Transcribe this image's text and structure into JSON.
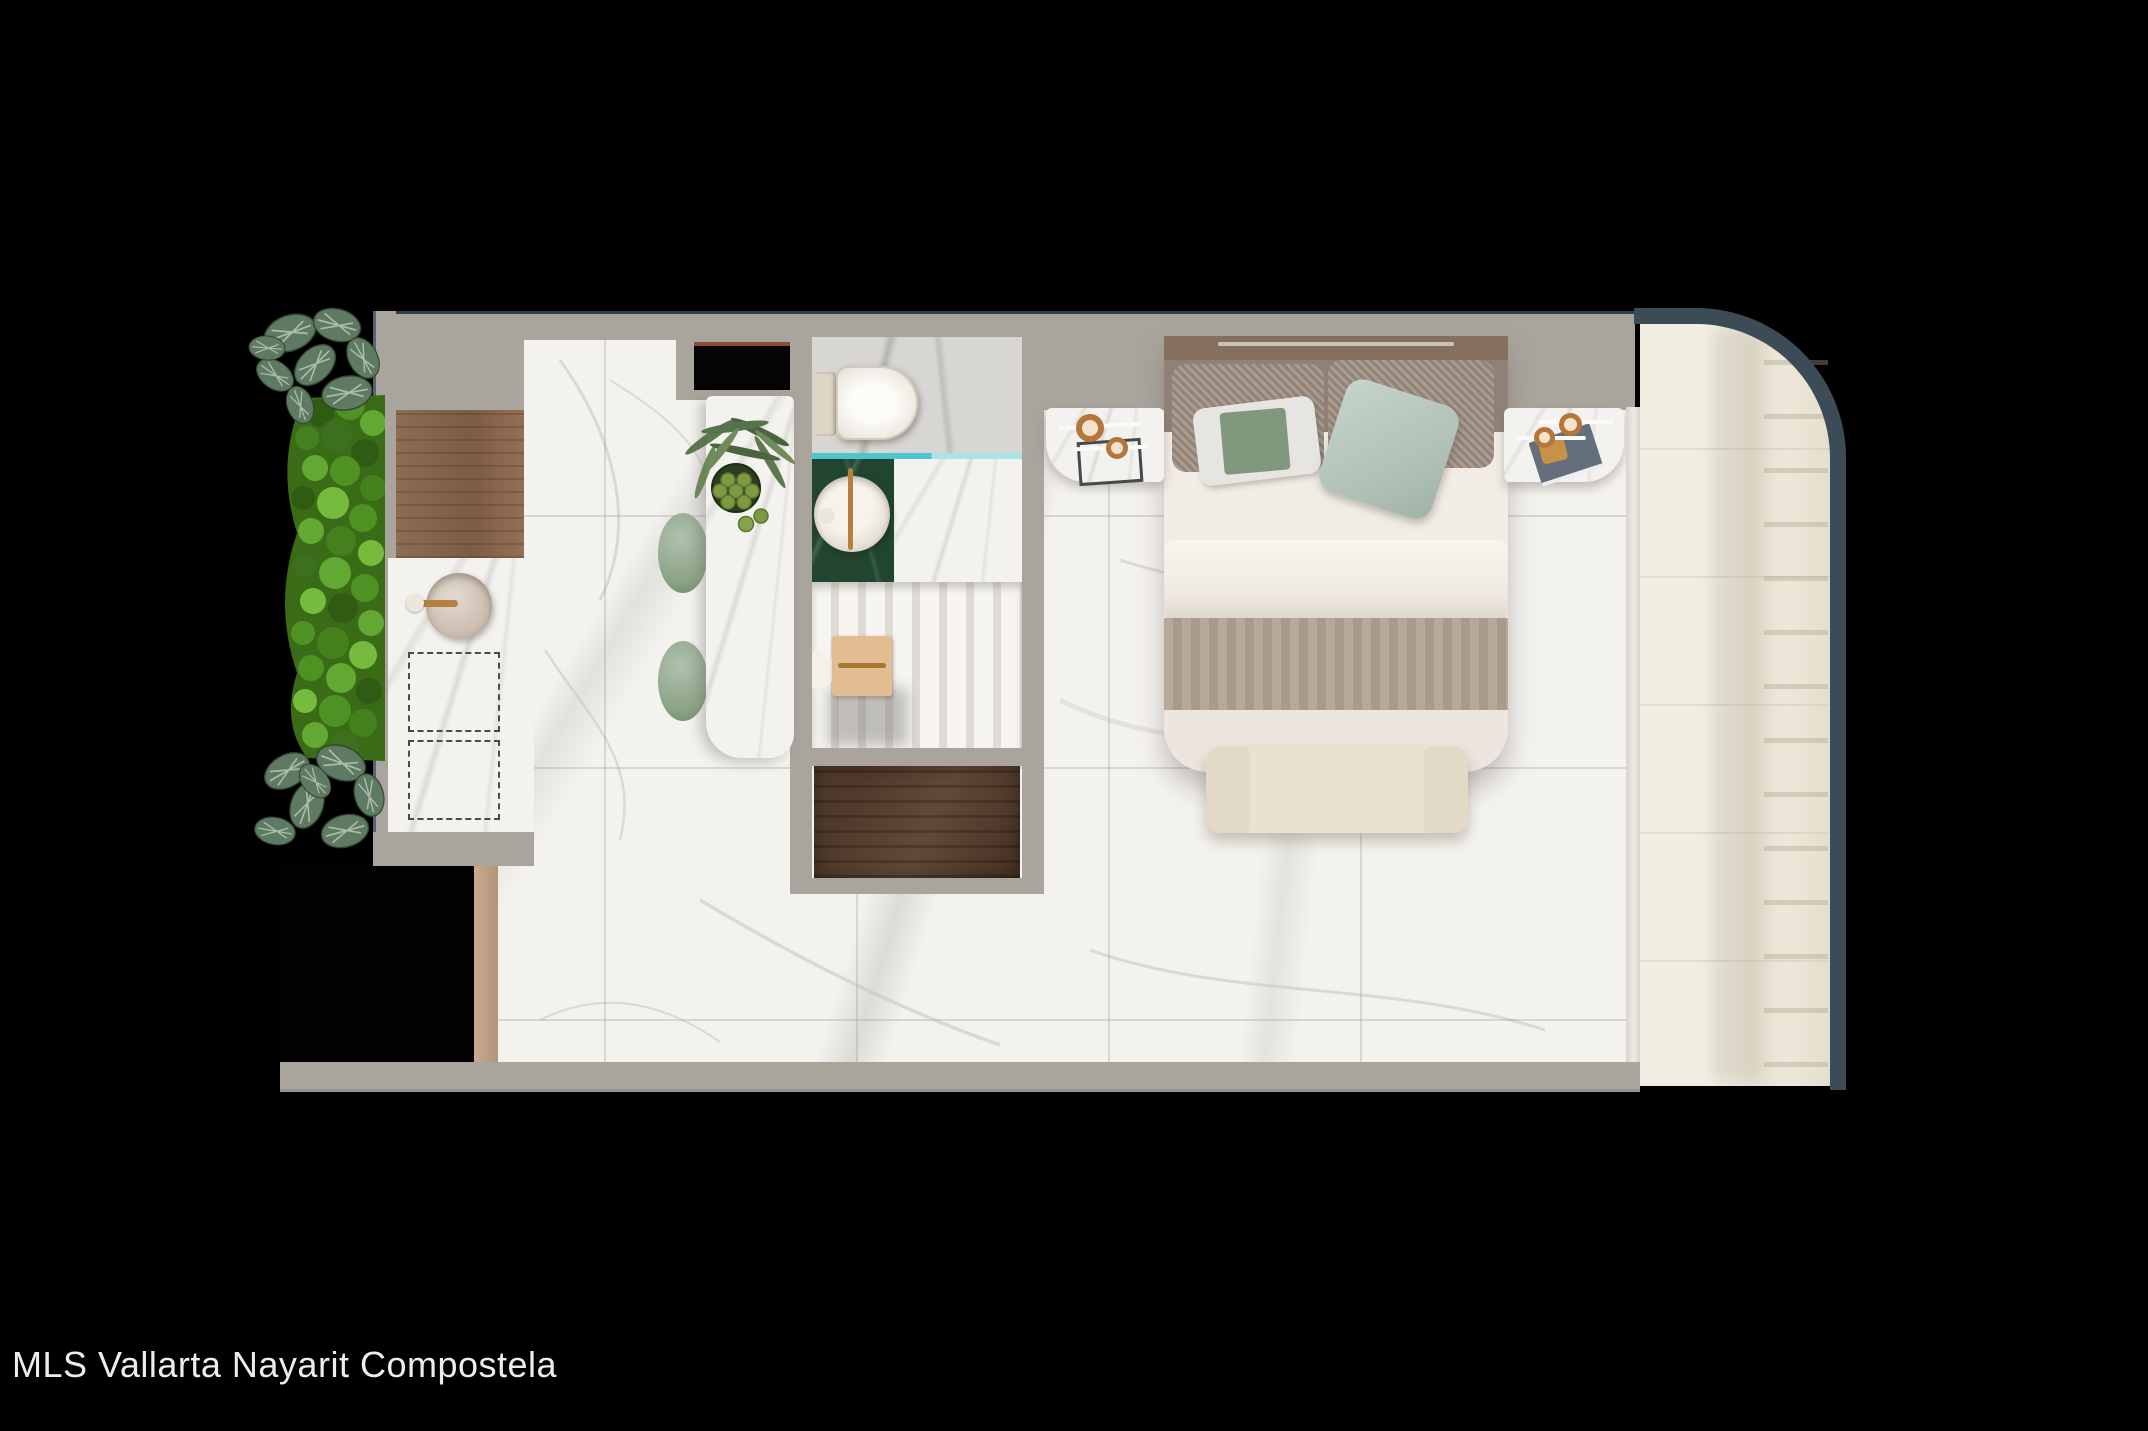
{
  "caption": "MLS Vallarta Nayarit Compostela",
  "palette": {
    "background": "#000000",
    "wall_gray": "#a9a59d",
    "floor_marble": "#f4f2ef",
    "bathroom_marble": "#d8d6d3",
    "wood_counter": "#8a6850",
    "wood_dresser": "#4e382a",
    "green_vanity": "#224530",
    "teal_glass": "#4cc4d1",
    "sage_green": "#9db29a",
    "balcony_floor": "#efeadd",
    "railing_slate": "#3b4c56",
    "duvet_cream": "#f1ece5",
    "runner_taupe": "#b1a395",
    "bench_cream": "#e9e2d1",
    "gold_accent": "#b5803e",
    "garden_green": "#4f9224",
    "caption_text": "#ededed"
  },
  "scene": {
    "type": "floor-plan-render",
    "areas": [
      "vertical-garden",
      "kitchen",
      "island",
      "entry",
      "bathroom",
      "closet",
      "bedroom",
      "balcony"
    ],
    "furniture": [
      "kitchen-counter",
      "kitchen-sink",
      "under-counter-appliances",
      "bar-stools",
      "island-plant",
      "toilet",
      "vanity-sink",
      "shower-glass",
      "closet-bench",
      "dresser",
      "double-bed",
      "accent-pillows",
      "nightstand-left",
      "nightstand-right",
      "bed-bench",
      "balcony-railing"
    ]
  }
}
